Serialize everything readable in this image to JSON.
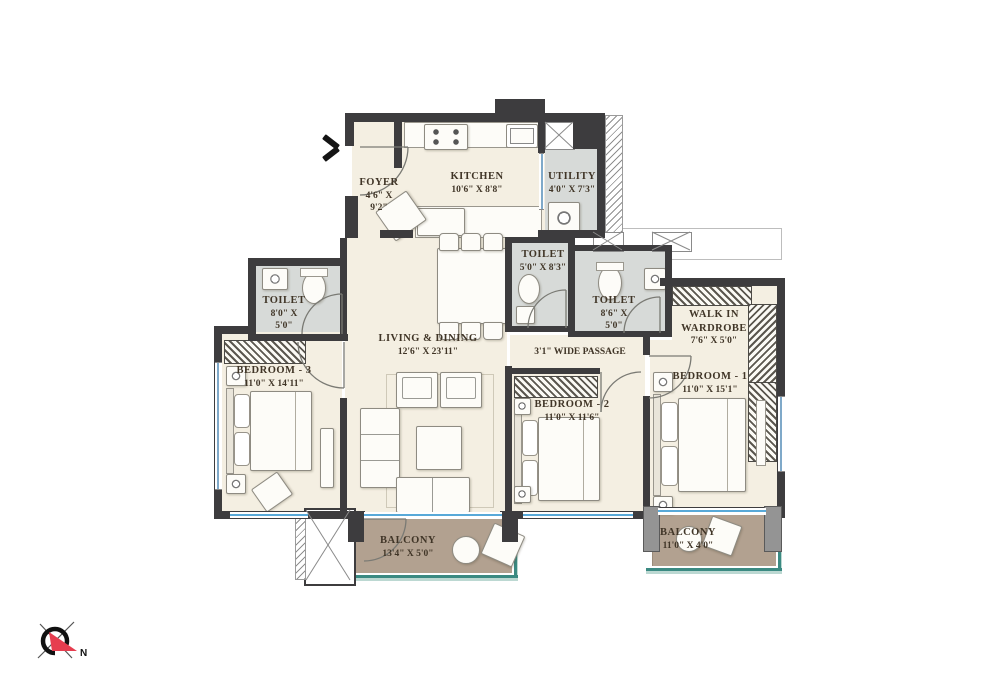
{
  "plan_title": "Apartment Floor Plan",
  "rooms": {
    "foyer": {
      "name": "FOYER",
      "dims": "4'6\" X 9'2\""
    },
    "kitchen": {
      "name": "KITCHEN",
      "dims": "10'6\" X 8'8\""
    },
    "utility": {
      "name": "UTILITY",
      "dims": "4'0\" X 7'3\""
    },
    "toilet_top": {
      "name": "TOILET",
      "dims": "5'0\" X 8'3\""
    },
    "toilet_mid": {
      "name": "TOILET",
      "dims": "8'6\" X 5'0\""
    },
    "toilet_left": {
      "name": "TOILET",
      "dims": "8'0\" X 5'0\""
    },
    "walk_in_wardrobe": {
      "name": "WALK IN WARDROBE",
      "dims": "7'6\" X 5'0\""
    },
    "living_dining": {
      "name": "LIVING & DINING",
      "dims": "12'6\" X 23'11\""
    },
    "passage": {
      "name": "3'1\" WIDE PASSAGE"
    },
    "bedroom_3": {
      "name": "BEDROOM - 3",
      "dims": "11'0\" X 14'11\""
    },
    "bedroom_2": {
      "name": "BEDROOM - 2",
      "dims": "11'0\" X 11'6\""
    },
    "bedroom_1": {
      "name": "BEDROOM - 1",
      "dims": "11'0\" X 15'1\""
    },
    "balcony_living": {
      "name": "BALCONY",
      "dims": "13'4\" X 5'0\""
    },
    "balcony_bed1": {
      "name": "BALCONY",
      "dims": "11'0\" X 4'0\""
    }
  },
  "compass": {
    "north_label": "N"
  },
  "icons": {
    "entrance": "entrance-arrow-icon",
    "compass": "compass-icon",
    "shaft": "shaft-x-icon"
  },
  "colors": {
    "wall": "#3d3c3e",
    "floor_cream": "#f4efe2",
    "floor_wet": "#d7dad8",
    "balcony_floor": "#b2a190",
    "balcony_rim": "#3b8a82",
    "window_blue": "#58a9d8",
    "compass_north_arrow": "#e63d4f",
    "label_text": "#403527"
  }
}
